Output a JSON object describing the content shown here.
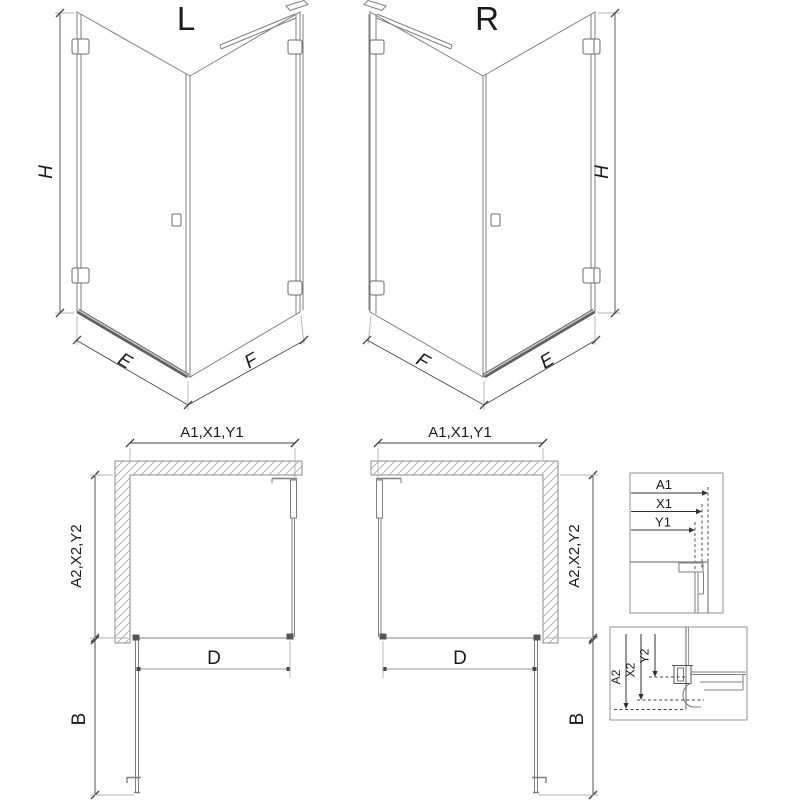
{
  "drawing": {
    "title_hint": "shower enclosure dimension drawing",
    "iso_left": {
      "variant_label": "L",
      "dim_height": "H",
      "dim_door_width": "E",
      "dim_fixed_width": "F"
    },
    "iso_right": {
      "variant_label": "R",
      "dim_height": "H",
      "dim_door_width": "E",
      "dim_fixed_width": "F"
    },
    "plan_left": {
      "dim_top": "A1,X1,Y1",
      "dim_side": "A2,X2,Y2",
      "dim_entry": "D",
      "dim_door_open": "B"
    },
    "plan_right": {
      "dim_top": "A1,X1,Y1",
      "dim_side": "A2,X2,Y2",
      "dim_entry": "D",
      "dim_door_open": "B"
    },
    "detail_wall_profile": {
      "dim_1": "A1",
      "dim_2": "X1",
      "dim_3": "Y1"
    },
    "detail_tray_profile": {
      "dim_1": "A2",
      "dim_2": "X2",
      "dim_3": "Y2"
    },
    "colors": {
      "background": "#ffffff",
      "drawing_line": "#7f7f7f",
      "dimension_line": "#3f3f3f",
      "extension_line": "#b0b0b0",
      "hatch": "#b4b4b4",
      "threshold_bar": "#606060",
      "text": "#1a1a1a"
    }
  }
}
